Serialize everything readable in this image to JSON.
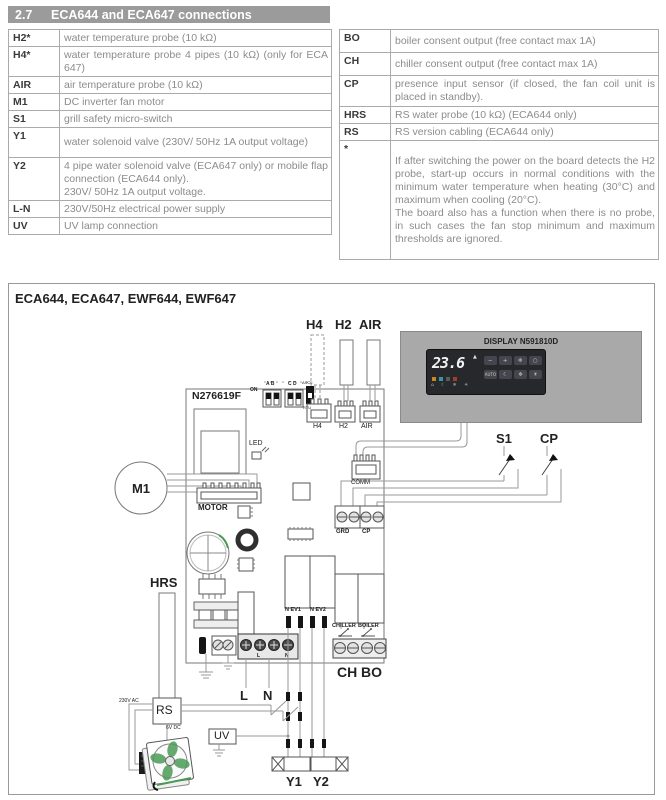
{
  "header": {
    "number": "2.7",
    "title": "ECA644 and ECA647 connections"
  },
  "tables": {
    "left": {
      "rows": [
        {
          "term": "H2*",
          "desc": "water temperature probe (10 kΩ)"
        },
        {
          "term": "H4*",
          "desc": "water temperature probe 4 pipes (10 kΩ) (only for ECA 647)"
        },
        {
          "term": "AIR",
          "desc": "air temperature probe (10 kΩ)"
        },
        {
          "term": "M1",
          "desc": "DC inverter fan motor"
        },
        {
          "term": "S1",
          "desc": "grill safety micro-switch"
        },
        {
          "term": "Y1",
          "desc": "water solenoid valve (230V/ 50Hz 1A output voltage)"
        },
        {
          "term": "Y2",
          "desc": "4 pipe water solenoid valve (ECA647 only) or mobile flap connection (ECA644 only).\n230V/ 50Hz 1A output voltage."
        },
        {
          "term": "L-N",
          "desc": "230V/50Hz electrical power supply"
        },
        {
          "term": "UV",
          "desc": "UV lamp connection"
        }
      ]
    },
    "right": {
      "rows": [
        {
          "term": "BO",
          "desc": "boiler consent output (free contact max 1A)"
        },
        {
          "term": "CH",
          "desc": "chiller consent output (free contact max 1A)"
        },
        {
          "term": "CP",
          "desc": "presence input sensor (if closed, the fan coil unit is placed in standby)."
        },
        {
          "term": "HRS",
          "desc": "RS water probe (10 kΩ) (ECA644 only)"
        },
        {
          "term": "RS",
          "desc": "RS version cabling (ECA644 only)"
        },
        {
          "term": "*",
          "desc": "If after switching the power on the board detects the H2 probe, start-up occurs in normal conditions with the minimum water temperature when heating (30°C) and maximum when cooling (20°C).\nThe board also has a function when there is no probe, in such cases the fan stop minimum and maximum thresholds are ignored."
        }
      ]
    }
  },
  "diagram": {
    "title": "ECA644, ECA647, EWF644, EWF647",
    "board_code": "N276619F",
    "labels": {
      "h4_probe": "H4",
      "h2_probe": "H2",
      "air_probe": "AIR",
      "h4_conn": "H4",
      "h2_conn": "H2",
      "air_conn": "AIR",
      "on": "ON",
      "ab": "A B",
      "cd": "C D",
      "ascii": "ASCII",
      "rtu": "RTU",
      "led": "LED",
      "m1": "M1",
      "motor": "MOTOR",
      "comm": "COMM",
      "s1": "S1",
      "cp_switch": "CP",
      "grd": "GRD",
      "cp_terminal": "CP",
      "hrs": "HRS",
      "n_ev1": "N EV1",
      "n_ev2": "N EV2",
      "chiller": "CHILLER",
      "boiler": "BOILER",
      "ch": "CH",
      "bo": "BO",
      "l": "L",
      "n": "N",
      "l_mark": "L",
      "n_mark": "N",
      "plus": "+",
      "v230": "230V AC",
      "rs": "RS",
      "v6": "6V DC",
      "uv": "UV",
      "y1": "Y1",
      "y2": "Y2"
    },
    "display": {
      "title": "DISPLAY N591810D",
      "value": "23.6",
      "up_arrow": "▲",
      "buttons_row1": [
        "−",
        "+",
        "❄",
        "○"
      ],
      "buttons_row2": [
        "AUTO",
        "☾",
        "❄",
        "☀"
      ],
      "led_colors": [
        "#c9881f",
        "#2f9aa0",
        "#5a5a5a",
        "#a33b2e"
      ],
      "status_icons": "⌂ ☾ ❄ ☀"
    },
    "colors": {
      "header_bg": "#9b9b9b",
      "table_border": "#aaaaaa",
      "term_color": "#3a3a3a",
      "desc_color": "#8c8c8c",
      "wire": "#999999",
      "fan_green": "#4a9a55",
      "display_bg": "#a9a9a9",
      "panel_bg": "#26282c"
    }
  }
}
